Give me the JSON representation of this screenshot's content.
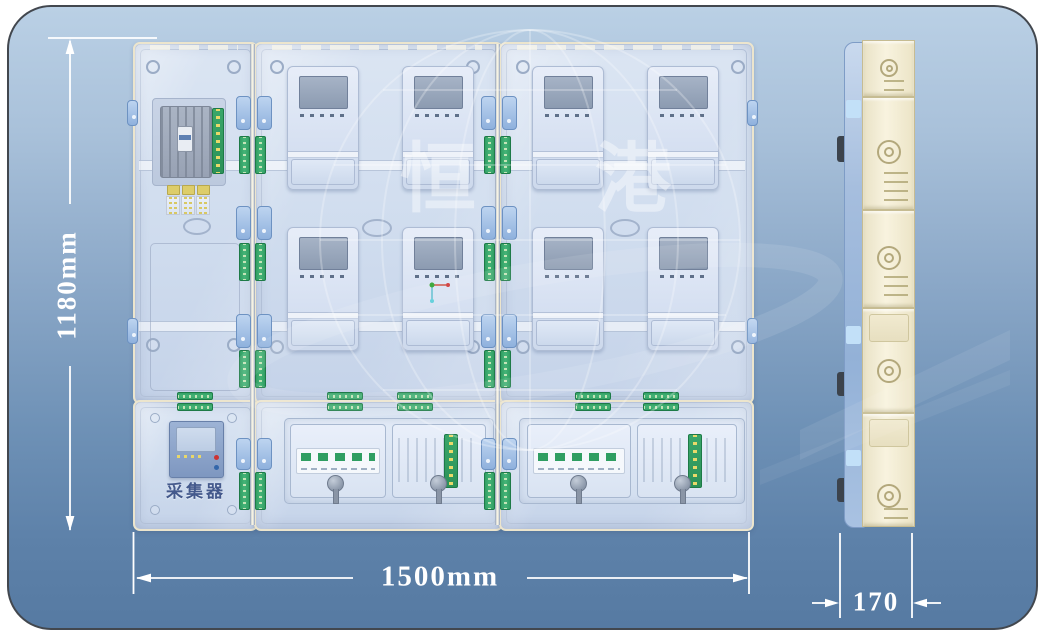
{
  "image_type": "technical product drawing of a transparent multi-meter electric meter box, front view and side view",
  "watermark": {
    "left_char": "恒",
    "right_char": "港"
  },
  "dimensions": {
    "height_label": "1180mm",
    "width_label": "1500mm",
    "depth_label": "170"
  },
  "front_view": {
    "collector_label": "采集器",
    "service_panel": "left column with main breaker, terminal board and fuse blocks",
    "meter_panels": 2,
    "meters_per_panel": 4,
    "total_meter_windows": 8,
    "bottom_boxes": 3
  },
  "side_view": {
    "segments": 5,
    "depth_label": "170"
  },
  "colors": {
    "background_top": "#bad0e5",
    "background_bottom": "#567aa2",
    "cabinet_body": "#d3dff0",
    "cabinet_frame": "#ece5cd",
    "terminal_green": "#35a468",
    "latch_blue": "#9dbde4",
    "side_view_cream": "#f4eed8",
    "dimension_color": "#ffffff",
    "collector_text": "#44598c",
    "indicator_red": "#cc3333",
    "indicator_blue": "#3366aa"
  }
}
